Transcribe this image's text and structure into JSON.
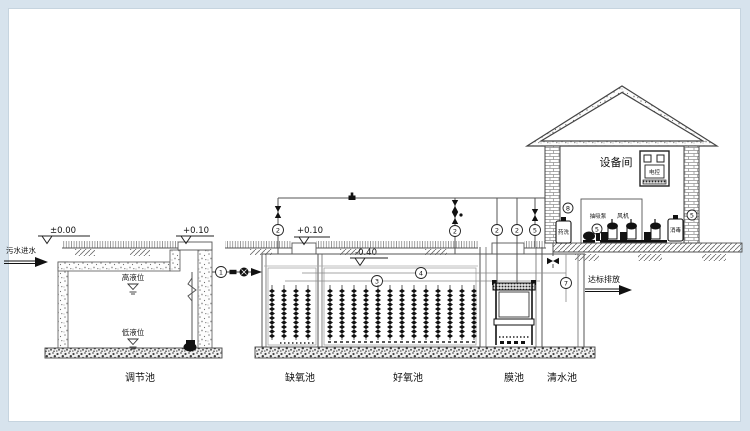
{
  "labels": {
    "elev_zero": "±0.00",
    "elev_p010_a": "+0.10",
    "elev_p010_b": "+0.10",
    "elev_n040": "-0.40",
    "inlet": "污水进水",
    "outlet": "达标排放",
    "high_level": "高液位",
    "low_level": "低液位"
  },
  "tanks": {
    "regulation": "调节池",
    "anoxic": "缺氧池",
    "aerobic": "好氧池",
    "membrane": "膜池",
    "clearwater": "清水池"
  },
  "equipment_room": {
    "title": "设备间",
    "suction_pump": "抽吸泵",
    "blower": "风机",
    "chem_wash_tank": "药洗",
    "disinfect_tank": "消毒",
    "control_panel": "电控"
  },
  "callouts": [
    {
      "n": "1"
    },
    {
      "n": "2"
    },
    {
      "n": "2"
    },
    {
      "n": "2"
    },
    {
      "n": "2"
    },
    {
      "n": "5"
    },
    {
      "n": "3"
    },
    {
      "n": "4"
    },
    {
      "n": "7"
    },
    {
      "n": "8"
    },
    {
      "n": "5"
    },
    {
      "n": "5"
    }
  ]
}
